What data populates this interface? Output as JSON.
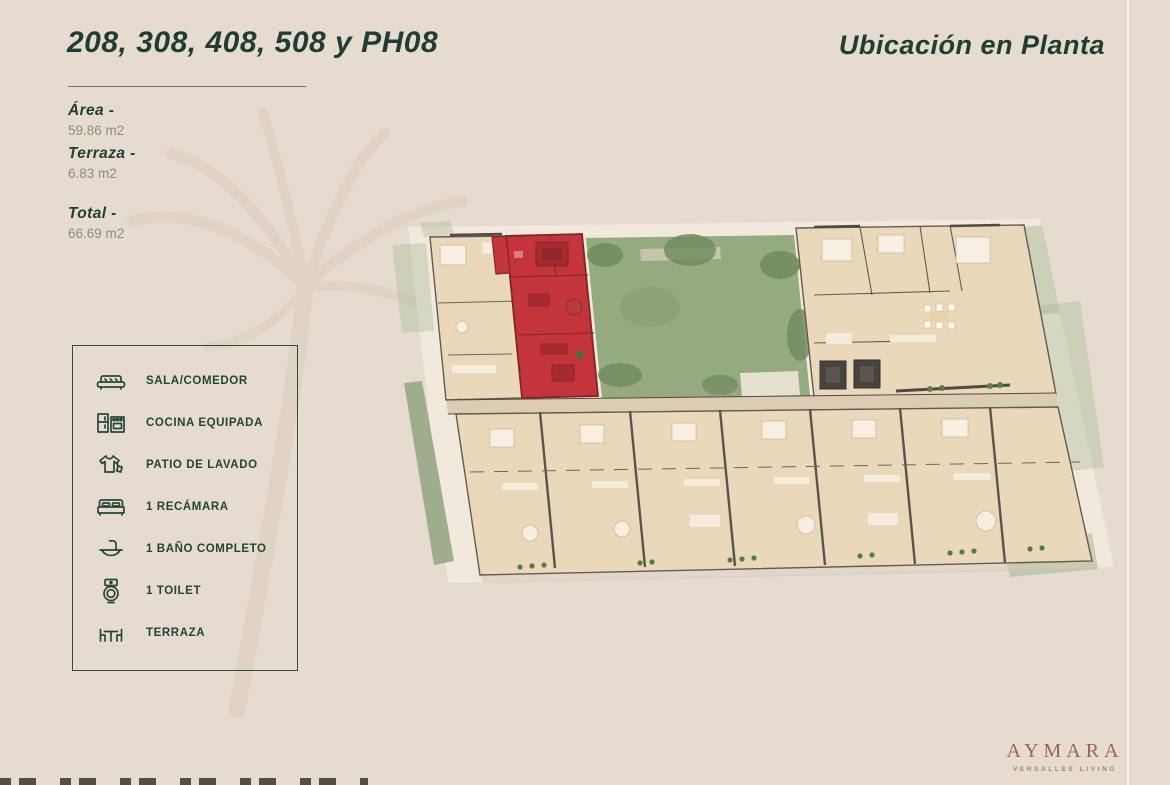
{
  "header": {
    "units_title": "208, 308, 408, 508 y PH08",
    "location_title": "Ubicación en Planta"
  },
  "specs": [
    {
      "label": "Área -",
      "value": "59.86 m2"
    },
    {
      "label": "Terraza -",
      "value": "6.83 m2"
    },
    {
      "label": "Total -",
      "value": "66.69 m2"
    }
  ],
  "legend": {
    "items": [
      {
        "icon": "sofa-icon",
        "label": "SALA/COMEDOR"
      },
      {
        "icon": "kitchen-icon",
        "label": "COCINA EQUIPADA"
      },
      {
        "icon": "laundry-icon",
        "label": "PATIO DE LAVADO"
      },
      {
        "icon": "bed-icon",
        "label": "1 RECÁMARA"
      },
      {
        "icon": "sink-icon",
        "label": "1 BAÑO COMPLETO"
      },
      {
        "icon": "toilet-icon",
        "label": "1 TOILET"
      },
      {
        "icon": "terrace-icon",
        "label": "TERRAZA"
      }
    ]
  },
  "floorplan": {
    "highlight_color": "#c22f34",
    "floor_color": "#ebd8ba",
    "courtyard_color": "#93a87d",
    "wall_color": "#55504a"
  },
  "footer": {
    "brand": "AYMARA",
    "tagline": "VERSALLES LIVING"
  },
  "colors": {
    "background": "#e5dccf",
    "accent_green": "#1f3d33",
    "text_gray": "#8f8b83",
    "brand_brown": "#9b6550"
  }
}
